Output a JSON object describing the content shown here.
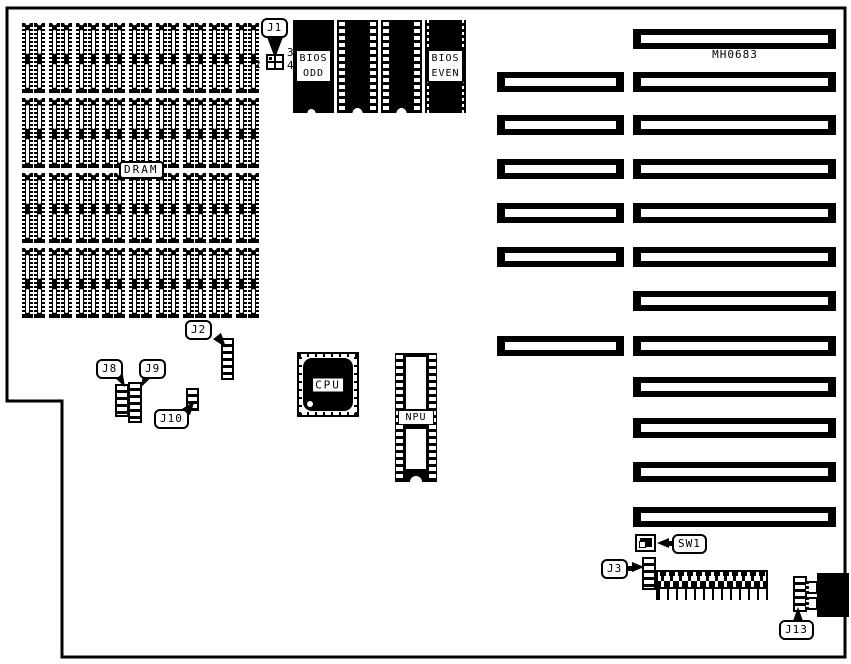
{
  "board": {
    "id": "MH0683",
    "colors": {
      "ink": "#000000",
      "paper": "#ffffff"
    }
  },
  "dram": {
    "label": "DRAM",
    "rows": 4,
    "chips_per_row": 18,
    "pairs_per_row": 9
  },
  "rom": {
    "odd": {
      "line1": "BIOS",
      "line2": "ODD"
    },
    "even": {
      "line1": "BIOS",
      "line2": "EVEN"
    }
  },
  "cpu": {
    "label": "CPU"
  },
  "npu": {
    "label": "NPU"
  },
  "connectors": {
    "j1": {
      "label": "J1",
      "pin2": "2",
      "pin3": "3",
      "pin4": "4"
    },
    "j2": {
      "label": "J2"
    },
    "j3": {
      "label": "J3"
    },
    "j8": {
      "label": "J8"
    },
    "j9": {
      "label": "J9"
    },
    "j10": {
      "label": "J10"
    },
    "j13": {
      "label": "J13"
    },
    "sw1": {
      "label": "SW1"
    }
  },
  "slots": {
    "long_count": 12,
    "short_row_indices": [
      1,
      2,
      3,
      4,
      5,
      7
    ]
  },
  "bottom_connector": {
    "positions": 12
  }
}
